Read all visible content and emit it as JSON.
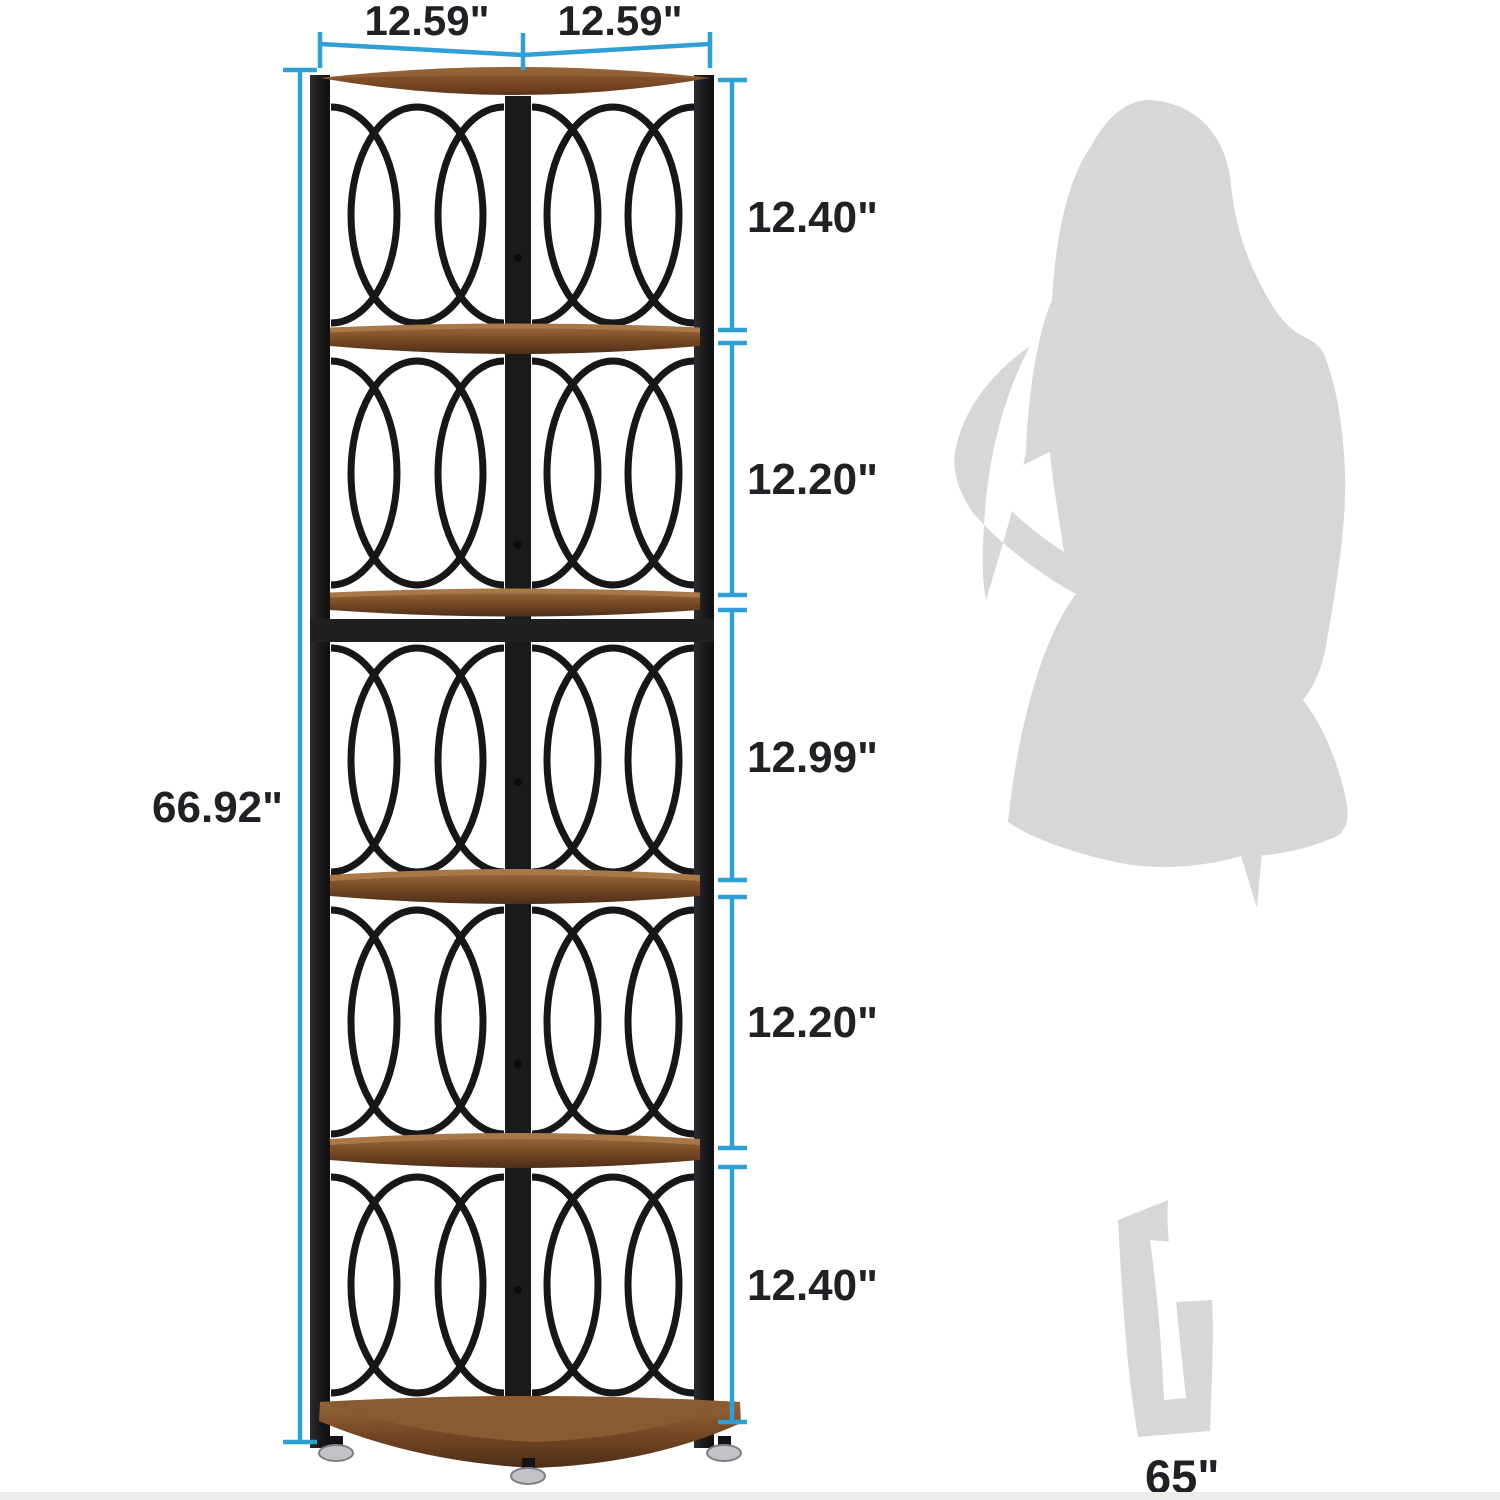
{
  "scene": {
    "type": "product-dimension-diagram",
    "subject": "5-tier corner shelf with scale silhouette"
  },
  "colors": {
    "annotation_line": "#2f9fd4",
    "label_text": "#202124",
    "wood": "#8a5a33",
    "wood_dark": "#55321b",
    "frame_black": "#1c1c1f",
    "silhouette_gray": "#d9d7d5",
    "background": "#ffffff"
  },
  "dimensions": {
    "top_width_left": "12.59\"",
    "top_width_right": "12.59\"",
    "total_height": "66.92\"",
    "right_segments": [
      {
        "label": "12.40\""
      },
      {
        "label": "12.20\""
      },
      {
        "label": "12.99\""
      },
      {
        "label": "12.20\""
      },
      {
        "label": "12.40\""
      }
    ],
    "person_height": "65\""
  },
  "shelf": {
    "tier_count": 5
  }
}
